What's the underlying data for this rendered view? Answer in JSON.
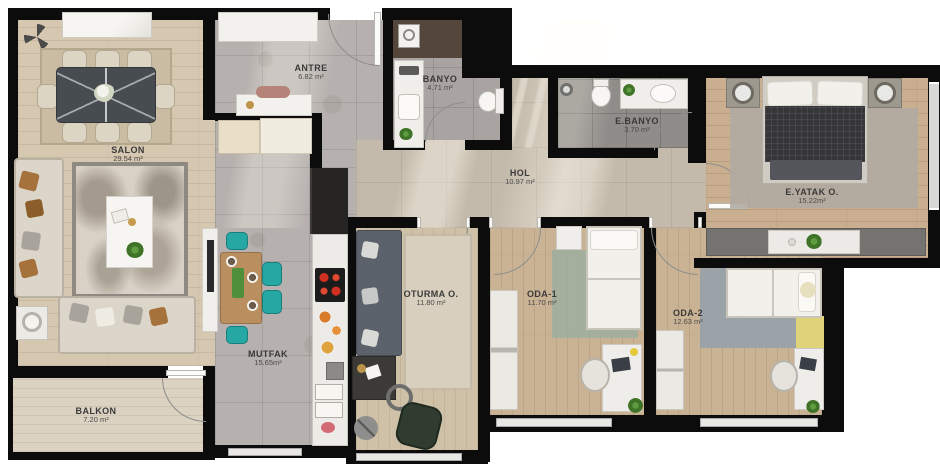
{
  "plan": {
    "type": "apartment-floor-plan",
    "rooms": [
      {
        "id": "salon",
        "label": "SALON",
        "area": "29.54 m²"
      },
      {
        "id": "antre",
        "label": "ANTRE",
        "area": "6.82 m²"
      },
      {
        "id": "banyo",
        "label": "BANYO",
        "area": "4.71 m²"
      },
      {
        "id": "ebanyo",
        "label": "E.BANYO",
        "area": "3.70 m²"
      },
      {
        "id": "hol",
        "label": "HOL",
        "area": "10.97 m²"
      },
      {
        "id": "eyatak",
        "label": "E.YATAK O.",
        "area": "15.22m²"
      },
      {
        "id": "mutfak",
        "label": "MUTFAK",
        "area": "15.65m²"
      },
      {
        "id": "oturma",
        "label": "OTURMA O.",
        "area": "11.80 m²"
      },
      {
        "id": "oda1",
        "label": "ODA-1",
        "area": "11.70 m²"
      },
      {
        "id": "oda2",
        "label": "ODA-2",
        "area": "12.63 m²"
      },
      {
        "id": "balkon",
        "label": "BALKON",
        "area": "7.20 m²"
      }
    ],
    "colors": {
      "walls": "#0c0c0d",
      "label_text": "#3a3a3a",
      "teal_chairs": "#27a7a4",
      "stove_burners": "#d03020",
      "master_bed_duvet": "#35353a",
      "oda1_rug": "#9fae9f",
      "oda2_rug": "#93a0ac",
      "yellow_mat": "#dfd37a",
      "armchair_green": "#303c2f"
    }
  }
}
